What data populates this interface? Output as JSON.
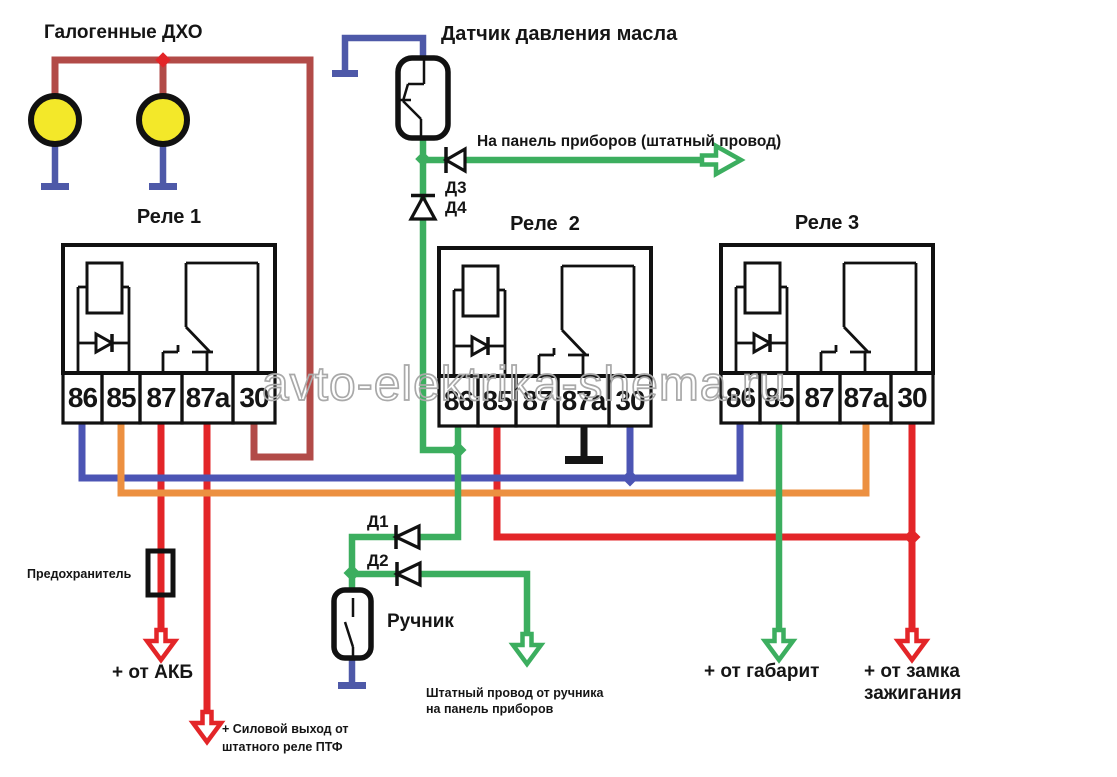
{
  "labels": {
    "drl": "Галогенные ДХО",
    "oil_sensor": "Датчик давления масла",
    "to_panel": "На панель приборов (штатный провод)",
    "d1": "Д1",
    "d2": "Д2",
    "d3": "Д3",
    "d4": "Д4",
    "fuse": "Предохранитель",
    "handbrake": "Ручник",
    "akb": "+ от АКБ",
    "ptf_line1": "+ Силовой выход от",
    "ptf_line2": "штатного реле ПТФ",
    "hb_panel_line1": "Штатный провод от ручника",
    "hb_panel_line2": "на панель приборов",
    "gabarit": "+ от габарит",
    "ignition_line1": "+ от замка",
    "ignition_line2": "зажигания",
    "watermark": "avto-elektrika-shema.ru"
  },
  "relays": [
    {
      "title": "Реле 1",
      "pins": [
        "86",
        "85",
        "87",
        "87а",
        "30"
      ]
    },
    {
      "title": "Реле  2",
      "pins": [
        "86",
        "85",
        "87",
        "87а",
        "30"
      ]
    },
    {
      "title": "Реле 3",
      "pins": [
        "86",
        "85",
        "87",
        "87а",
        "30"
      ]
    }
  ],
  "colors": {
    "wire_red": "#E32528",
    "wire_dark_red": "#B24B48",
    "wire_blue": "#4C55B4",
    "ground_blue": "#4E59A8",
    "wire_orange": "#EC9041",
    "wire_green": "#3CAE5F",
    "lamp_yellow": "#F3E829",
    "watermark_gray": "#A9A9A9"
  }
}
